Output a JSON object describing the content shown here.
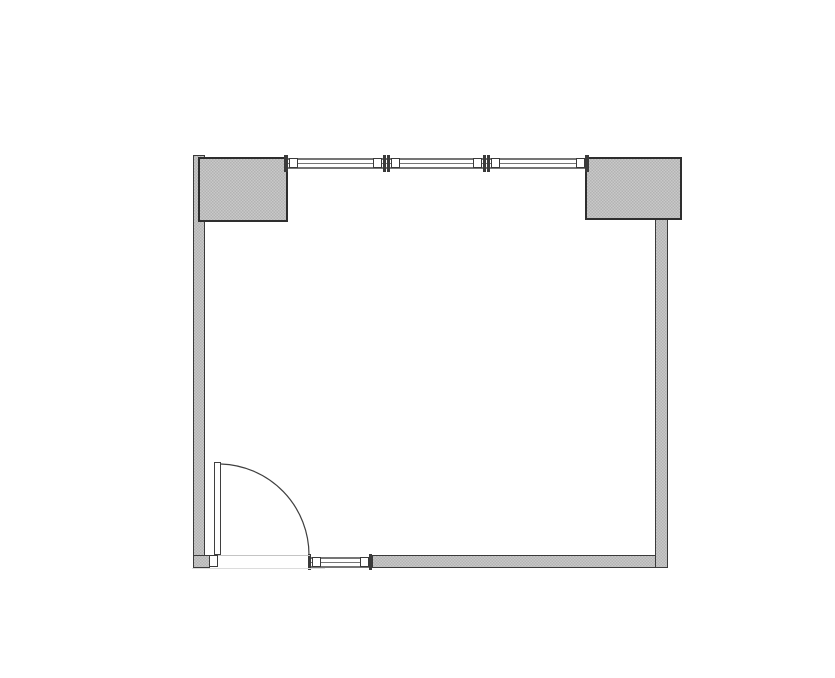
{
  "title": "room-floor-plan",
  "canvas": {
    "width": 835,
    "height": 678,
    "background": "#ffffff"
  },
  "colors": {
    "wall_fill_light": "#c9c9c9",
    "wall_fill_dark": "#b3b3b3",
    "wall_outline": "#3a3a3a",
    "block_outline": "#2e2e2e",
    "window_line": "#757575",
    "door_line": "#3f3f3f",
    "threshold_upper": "#c4c4c4",
    "threshold_lower": "#dcdcdc"
  },
  "elements": [
    {
      "kind": "window",
      "name": "top-window-band",
      "x": 288,
      "y": 158,
      "w": 297,
      "h": 11
    },
    {
      "kind": "window",
      "name": "bottom-window-band",
      "x": 310,
      "y": 557,
      "w": 62,
      "h": 11
    },
    {
      "kind": "wall",
      "name": "left-wall",
      "x": 193,
      "y": 155,
      "w": 12,
      "h": 413
    },
    {
      "kind": "wall",
      "name": "bottom-left-wall-stub",
      "x": 193,
      "y": 555,
      "w": 17,
      "h": 13
    },
    {
      "kind": "wall",
      "name": "bottom-wall",
      "x": 372,
      "y": 555,
      "w": 296,
      "h": 13
    },
    {
      "kind": "wall",
      "name": "right-wall",
      "x": 655,
      "y": 219,
      "w": 13,
      "h": 349
    },
    {
      "kind": "block",
      "name": "top-left-column",
      "x": 198,
      "y": 157,
      "w": 90,
      "h": 65
    },
    {
      "kind": "block",
      "name": "top-right-column",
      "x": 585,
      "y": 157,
      "w": 97,
      "h": 63
    },
    {
      "kind": "wbar",
      "name": "top-window-left-end-bar",
      "x": 284,
      "y": 155,
      "w": 4,
      "h": 17
    },
    {
      "kind": "wsquare",
      "name": "top-window-left-end-square",
      "x": 289,
      "y": 158,
      "w": 9,
      "h": 10
    },
    {
      "kind": "wsquare",
      "name": "top-window-mullion-1-left-square",
      "x": 373,
      "y": 158,
      "w": 9,
      "h": 10
    },
    {
      "kind": "wbar",
      "name": "top-window-mullion-1-bar-a",
      "x": 383,
      "y": 155,
      "w": 3,
      "h": 17
    },
    {
      "kind": "wbar",
      "name": "top-window-mullion-1-bar-b",
      "x": 387,
      "y": 155,
      "w": 3,
      "h": 17
    },
    {
      "kind": "wsquare",
      "name": "top-window-mullion-1-right-square",
      "x": 391,
      "y": 158,
      "w": 9,
      "h": 10
    },
    {
      "kind": "wsquare",
      "name": "top-window-mullion-2-left-square",
      "x": 473,
      "y": 158,
      "w": 9,
      "h": 10
    },
    {
      "kind": "wbar",
      "name": "top-window-mullion-2-bar-a",
      "x": 483,
      "y": 155,
      "w": 3,
      "h": 17
    },
    {
      "kind": "wbar",
      "name": "top-window-mullion-2-bar-b",
      "x": 487,
      "y": 155,
      "w": 3,
      "h": 17
    },
    {
      "kind": "wsquare",
      "name": "top-window-mullion-2-right-square",
      "x": 491,
      "y": 158,
      "w": 9,
      "h": 10
    },
    {
      "kind": "wsquare",
      "name": "top-window-right-end-square",
      "x": 576,
      "y": 158,
      "w": 9,
      "h": 10
    },
    {
      "kind": "wbar",
      "name": "top-window-right-end-bar",
      "x": 585,
      "y": 155,
      "w": 4,
      "h": 17
    },
    {
      "kind": "wbar",
      "name": "bottom-window-left-end-bar",
      "x": 308,
      "y": 554,
      "w": 3,
      "h": 16
    },
    {
      "kind": "wsquare",
      "name": "bottom-window-left-end-square",
      "x": 312,
      "y": 557,
      "w": 9,
      "h": 10
    },
    {
      "kind": "wsquare",
      "name": "bottom-window-right-end-square",
      "x": 360,
      "y": 557,
      "w": 9,
      "h": 10
    },
    {
      "kind": "wbar",
      "name": "bottom-window-right-end-bar",
      "x": 369,
      "y": 554,
      "w": 3,
      "h": 16
    },
    {
      "kind": "line",
      "name": "door-threshold-upper",
      "x": 218,
      "y": 555,
      "w": 92,
      "h": 1,
      "color": "#c4c4c4"
    },
    {
      "kind": "line",
      "name": "door-threshold-lower",
      "x": 192,
      "y": 568,
      "w": 133,
      "h": 1,
      "color": "#dcdcdc"
    },
    {
      "kind": "jamb",
      "name": "door-jamb",
      "x": 209,
      "y": 555,
      "w": 9,
      "h": 12
    },
    {
      "kind": "leaf",
      "name": "door-leaf",
      "x": 214,
      "y": 462,
      "w": 7,
      "h": 93
    }
  ],
  "door_arc": {
    "start": [
      221,
      464
    ],
    "end": [
      309,
      555
    ],
    "radius": 91
  }
}
